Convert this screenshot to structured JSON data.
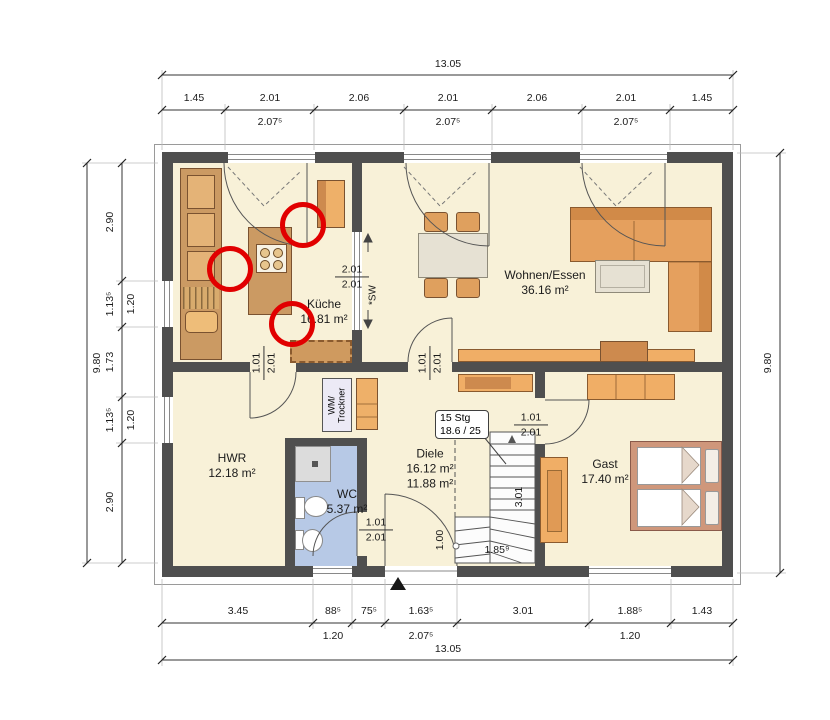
{
  "plan": {
    "rooms": [
      {
        "name": "Küche",
        "area": "16.81 m²"
      },
      {
        "name": "Wohnen/Essen",
        "area": "36.16 m²"
      },
      {
        "name": "HWR",
        "area": "12.18 m²"
      },
      {
        "name": "WC",
        "area": "5.37 m²"
      },
      {
        "name": "Diele",
        "area": "16.12 m²",
        "area_alt": "11.88 m²"
      },
      {
        "name": "Gast",
        "area": "17.40 m²"
      }
    ],
    "appliance_label": {
      "line1": "WM/",
      "line2": "Trockner"
    },
    "stair": {
      "label_line1": "15 Stg",
      "label_line2": "18.6 / 25",
      "run_length": "3.01",
      "bottom_width": "1.00",
      "bottom_length": "1.85⁹"
    },
    "window_note": "*SW"
  },
  "dims": {
    "top": {
      "overall": "13.05",
      "segments": [
        "1.45",
        "2.01",
        "2.06",
        "2.01",
        "2.06",
        "2.01",
        "1.45"
      ],
      "subs": [
        "2.07⁵",
        "2.07⁵",
        "2.07⁵"
      ]
    },
    "bottom": {
      "overall": "13.05",
      "segments": [
        "3.45",
        "88⁵",
        "75⁵",
        "1.63⁵",
        "3.01",
        "1.88⁵",
        "1.43"
      ],
      "subs": [
        "1.20",
        "2.07⁵",
        "1.20"
      ]
    },
    "left": {
      "overall": "9.80",
      "segments": [
        "2.90",
        "1.13⁵",
        "1.73",
        "1.13⁵",
        "2.90"
      ],
      "subs": [
        "1.20",
        "1.20"
      ]
    },
    "right": {
      "overall": "9.80"
    }
  },
  "door_dims": {
    "kitchen_passage": {
      "top": "2.01",
      "bottom": "2.01"
    },
    "hwr_door": {
      "top": "1.01",
      "bottom": "2.01"
    },
    "living_door": {
      "top": "1.01",
      "bottom": "2.01"
    },
    "wc_door": {
      "top": "1.01",
      "bottom": "2.01"
    },
    "gast_door": {
      "top": "1.01",
      "bottom": "2.01"
    }
  },
  "annotations": {
    "marker_color": "#e10000",
    "markers": [
      {
        "x": 303,
        "y": 225
      },
      {
        "x": 230,
        "y": 269
      },
      {
        "x": 292,
        "y": 324
      }
    ]
  },
  "colors": {
    "wall": "#4f4f4f",
    "floor": "#f8f1d8",
    "wc_floor": "#b7c9e6",
    "furniture_light": "#f0ae66",
    "furniture_wood": "#cb9a63",
    "annotation": "#e10000"
  }
}
